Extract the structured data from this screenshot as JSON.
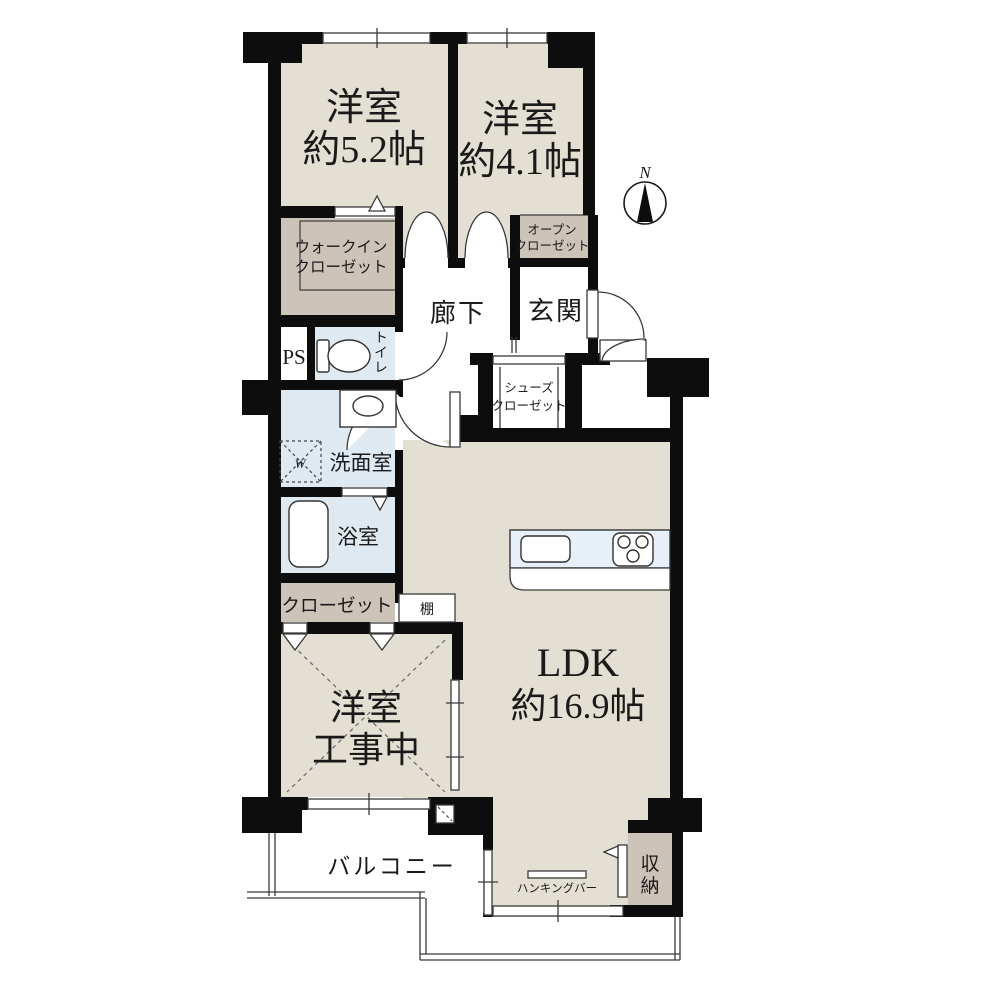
{
  "colors": {
    "wall": "#0d0d0d",
    "room_beige": "#e4dfd3",
    "closet_gray": "#ccc3b9",
    "wet_blue": "#dfe9f1",
    "kitchen_blue": "#e7eff8",
    "background": "#ffffff"
  },
  "compass": {
    "label": "N"
  },
  "rooms": {
    "bedroom1": {
      "name": "洋室",
      "size": "約5.2帖"
    },
    "bedroom2": {
      "name": "洋室",
      "size": "約4.1帖"
    },
    "bedroom3": {
      "name": "洋室",
      "status": "工事中"
    },
    "ldk": {
      "name": "LDK",
      "size": "約16.9帖"
    },
    "hallway": {
      "name": "廊下"
    },
    "entrance": {
      "name": "玄関"
    },
    "walk_in_closet": {
      "line1": "ウォークイン",
      "line2": "クローゼット"
    },
    "open_closet": {
      "line1": "オープン",
      "line2": "クローゼット"
    },
    "shoes_closet": {
      "line1": "シューズ",
      "line2": "クローゼット"
    },
    "pipe_space": {
      "name": "PS"
    },
    "toilet": {
      "name": "トイレ",
      "chars": [
        "ト",
        "イ",
        "レ"
      ]
    },
    "washroom": {
      "name": "洗面室",
      "washer_mark": "W"
    },
    "bathroom": {
      "name": "浴室"
    },
    "closet": {
      "name": "クローゼット"
    },
    "shelf": {
      "name": "棚"
    },
    "storage": {
      "name": "収納",
      "chars": [
        "収",
        "納"
      ]
    },
    "balcony": {
      "name": "バルコニー"
    },
    "hanging_bar": {
      "name": "ハンキングバー"
    }
  }
}
